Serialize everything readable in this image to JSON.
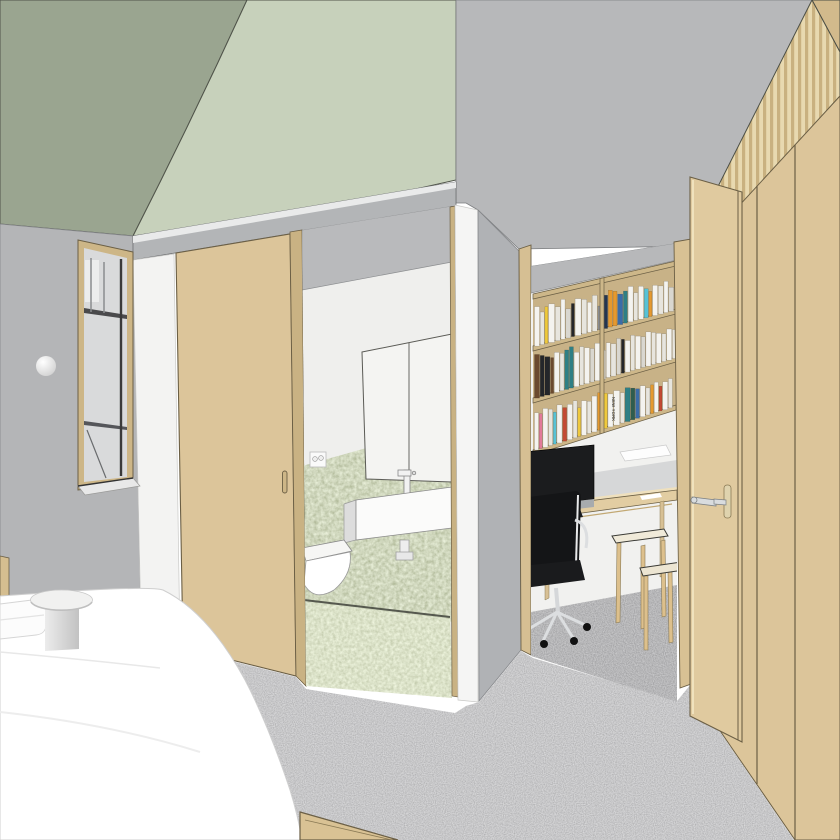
{
  "scene": {
    "description": "3D architectural interior rendering",
    "view": "bedroom looking toward ensuite bathroom and study nook with open wardrobe door"
  },
  "palette": {
    "ceiling_dark_green": "#9aa590",
    "ceiling_light_green": "#c7d1bb",
    "wall_gray": "#b4b5b7",
    "wall_white": "#f3f3f2",
    "wood_tan": "#dcc59a",
    "wood_dark": "#c9b283",
    "bath_tile_green": "#a6b087",
    "bath_floor_green": "#b1bb8d",
    "carpet_gray": "#8e8e90",
    "fixture_white": "#fbfbfa",
    "screen_black": "#1b1c1e",
    "chair_black": "#141517",
    "metal_silver": "#d9dcde"
  },
  "study": {
    "bookshelf": {
      "x0": 533,
      "x1": 676,
      "boards": [
        [
          294,
          261
        ],
        [
          346,
          309
        ],
        [
          398,
          357
        ],
        [
          450,
          405
        ]
      ],
      "divider_x": 602,
      "board_color": "#cdb789",
      "back_color": "#c8b287",
      "spine_colors": [
        "#f4f3ef",
        "#e7e5de",
        "#d9d7d0",
        "#efc93c",
        "#e5992f",
        "#2e7f85",
        "#3a6ca8",
        "#24262a",
        "#2f5d4f",
        "#243550",
        "#c34a33",
        "#e27a9a",
        "#56c2d6",
        "#6b4a2f",
        "#8c8f94"
      ],
      "rows": [
        {
          "board": 1,
          "hL": 44,
          "hR": 34,
          "books": [
            [
              5,
              0.9,
              0
            ],
            [
              4,
              0.75,
              1
            ],
            [
              3,
              0.85,
              3
            ],
            [
              6,
              0.9,
              0
            ],
            [
              5,
              0.8,
              1
            ],
            [
              4,
              0.95,
              0
            ],
            [
              5,
              0.7,
              2
            ],
            [
              3,
              0.8,
              7
            ],
            [
              6,
              0.9,
              0
            ],
            [
              5,
              0.85,
              1
            ],
            [
              4,
              0.75,
              0
            ],
            [
              5,
              0.9,
              1
            ],
            [
              4,
              0.6,
              14
            ],
            [
              5,
              0.85,
              9
            ],
            [
              4,
              0.95,
              4
            ],
            [
              4,
              0.9,
              4
            ],
            [
              5,
              0.8,
              6
            ],
            [
              4,
              0.85,
              5
            ],
            [
              5,
              0.95,
              0
            ],
            [
              4,
              0.75,
              1
            ],
            [
              5,
              0.9,
              0
            ],
            [
              4,
              0.8,
              12
            ],
            [
              3,
              0.7,
              4
            ],
            [
              5,
              0.85,
              0
            ],
            [
              5,
              0.8,
              1
            ],
            [
              4,
              0.9,
              0
            ],
            [
              5,
              0.7,
              2
            ],
            [
              4,
              0.85,
              0
            ]
          ]
        },
        {
          "board": 2,
          "hL": 46,
          "hR": 36,
          "books": [
            [
              5,
              0.95,
              13
            ],
            [
              4,
              0.9,
              7
            ],
            [
              5,
              0.85,
              7
            ],
            [
              3,
              0.8,
              13
            ],
            [
              5,
              0.9,
              0
            ],
            [
              4,
              0.85,
              1
            ],
            [
              4,
              0.9,
              5
            ],
            [
              4,
              0.95,
              5
            ],
            [
              5,
              0.8,
              0
            ],
            [
              4,
              0.9,
              1
            ],
            [
              5,
              0.85,
              0
            ],
            [
              4,
              0.8,
              2
            ],
            [
              5,
              0.9,
              0
            ],
            [
              5,
              0.7,
              1
            ],
            [
              4,
              0.85,
              0
            ],
            [
              5,
              0.8,
              1
            ],
            [
              4,
              0.9,
              2
            ],
            [
              3,
              0.85,
              7
            ],
            [
              5,
              0.8,
              0
            ],
            [
              4,
              0.9,
              1
            ],
            [
              5,
              0.85,
              0
            ],
            [
              4,
              0.8,
              2
            ],
            [
              5,
              0.9,
              0
            ],
            [
              4,
              0.85,
              1
            ],
            [
              5,
              0.8,
              0
            ],
            [
              4,
              0.75,
              1
            ],
            [
              5,
              0.85,
              0
            ],
            [
              4,
              0.8,
              1
            ]
          ]
        },
        {
          "board": 3,
          "hL": 44,
          "hR": 34,
          "books": [
            [
              4,
              0.85,
              0
            ],
            [
              3,
              0.8,
              11
            ],
            [
              5,
              0.9,
              0
            ],
            [
              4,
              0.85,
              1
            ],
            [
              3,
              0.75,
              12
            ],
            [
              5,
              0.9,
              0
            ],
            [
              4,
              0.8,
              10
            ],
            [
              5,
              0.85,
              0
            ],
            [
              4,
              0.9,
              1
            ],
            [
              3,
              0.7,
              3
            ],
            [
              5,
              0.85,
              0
            ],
            [
              4,
              0.8,
              1
            ],
            [
              5,
              0.9,
              0
            ],
            [
              5,
              0.95,
              4
            ],
            [
              4,
              0.9,
              3
            ],
            [
              5,
              0.85,
              0
            ],
            [
              6,
              0.9,
              0
            ],
            [
              4,
              0.8,
              1
            ],
            [
              5,
              0.9,
              5
            ],
            [
              4,
              0.85,
              8
            ],
            [
              4,
              0.8,
              6
            ],
            [
              5,
              0.85,
              0
            ],
            [
              4,
              0.75,
              1
            ],
            [
              3,
              0.8,
              4
            ],
            [
              4,
              0.85,
              0
            ],
            [
              3,
              0.7,
              10
            ],
            [
              5,
              0.8,
              0
            ],
            [
              4,
              0.85,
              1
            ]
          ]
        }
      ],
      "featured_spine_label": "NEW YORK",
      "featured": {
        "row": 2,
        "index": 15
      }
    }
  }
}
